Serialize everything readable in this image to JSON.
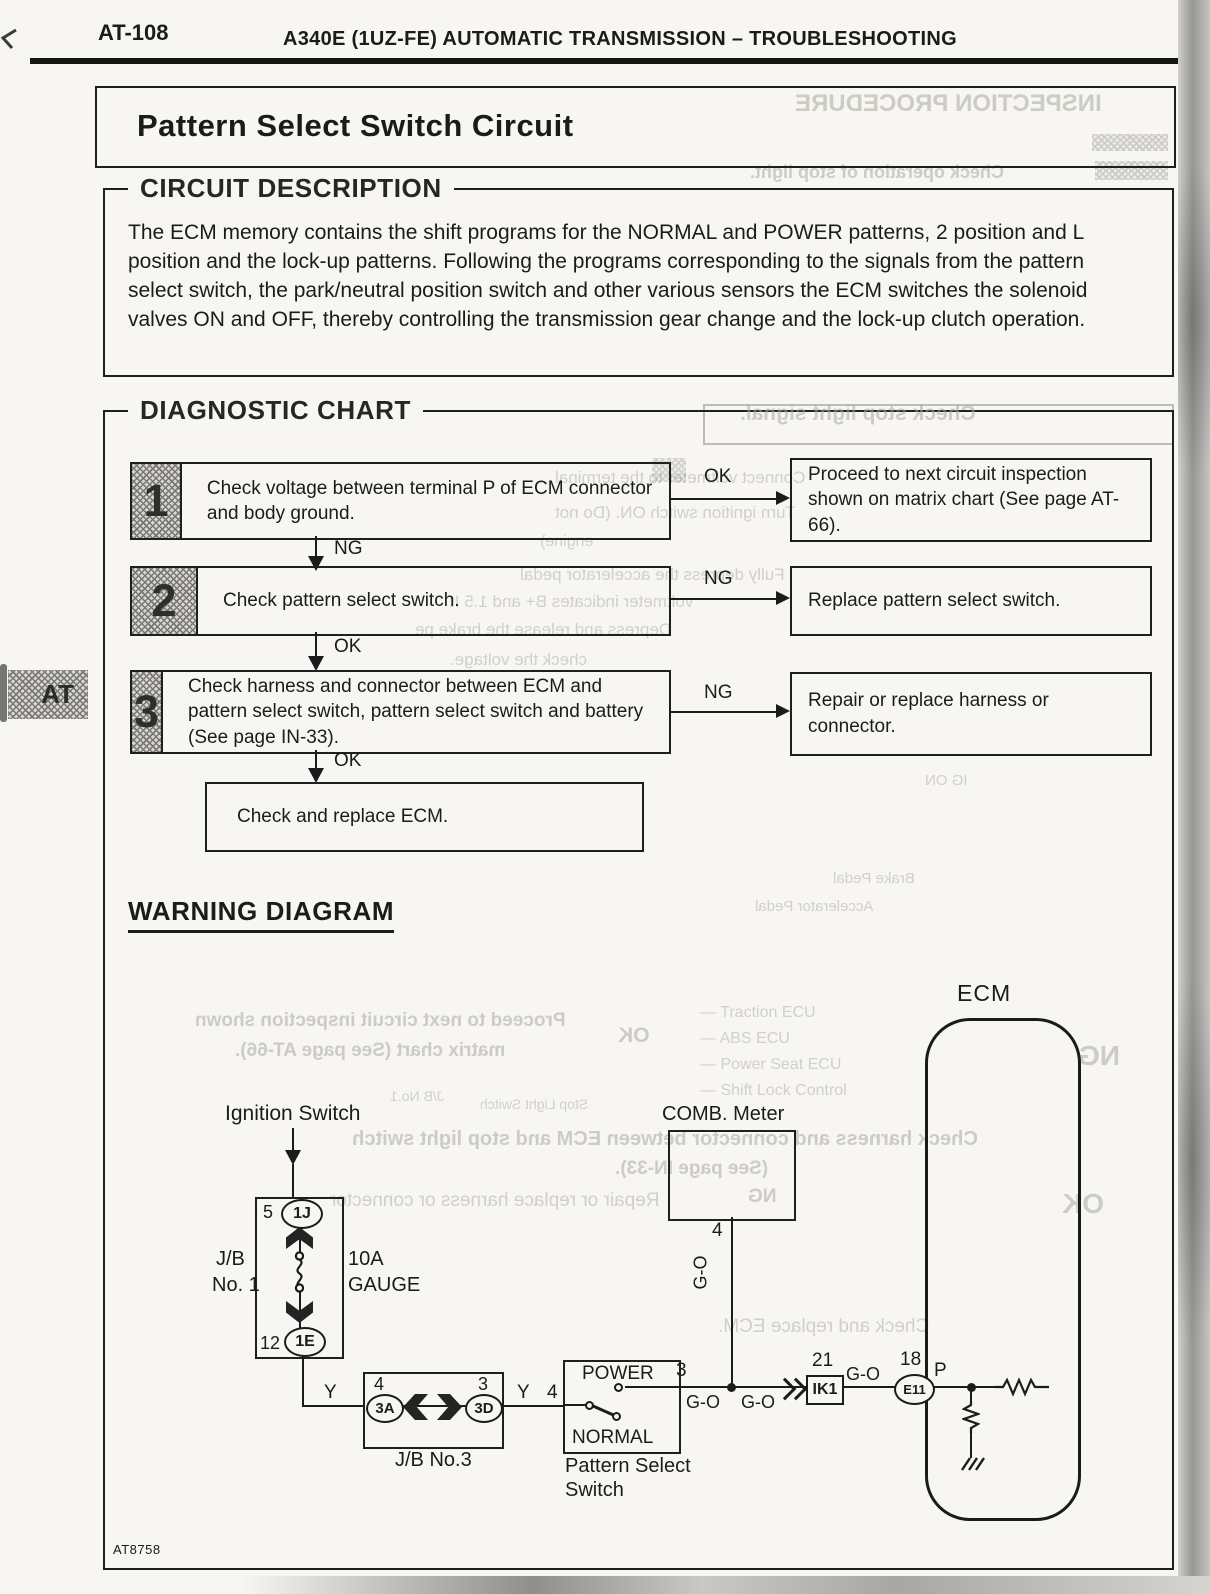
{
  "page": {
    "code": "AT-108",
    "header_title": "A340E (1UZ-FE) AUTOMATIC TRANSMISSION – TROUBLESHOOTING",
    "side_tab": "AT",
    "figure_code": "AT8758"
  },
  "title": "Pattern Select Switch Circuit",
  "circuit_description": {
    "heading": "CIRCUIT DESCRIPTION",
    "body": "The ECM memory contains the shift programs for the NORMAL and POWER patterns, 2 position and L position and the lock-up patterns. Following the programs corresponding to the signals from the pattern select switch, the park/neutral position switch and other various sensors the ECM switches the solenoid valves ON and OFF, thereby controlling the transmission gear change and the lock-up clutch operation."
  },
  "diagnostic_chart": {
    "heading": "DIAGNOSTIC CHART",
    "steps": [
      {
        "num": "1",
        "text": "Check voltage between terminal P of ECM connector and body ground.",
        "side_label": "OK",
        "side_result": "Proceed to next circuit inspection shown on matrix chart (See page AT-66).",
        "down_label": "NG"
      },
      {
        "num": "2",
        "text": "Check pattern select switch.",
        "side_label": "NG",
        "side_result": "Replace pattern select switch.",
        "down_label": "OK"
      },
      {
        "num": "3",
        "text": "Check harness and connector between ECM and pattern select switch, pattern select switch and battery (See page IN-33).",
        "side_label": "NG",
        "side_result": "Repair or replace harness or connector.",
        "down_label": "OK"
      }
    ],
    "final_step": "Check and replace ECM."
  },
  "wiring_diagram": {
    "heading": "WARNING DIAGRAM",
    "ignition_switch": "Ignition Switch",
    "jb1_name_line1": "J/B",
    "jb1_name_line2": "No. 1",
    "fuse_rating": "10A",
    "fuse_name": "GAUGE",
    "jb1_pin_top": "5",
    "jb1_conn_top": "1J",
    "jb1_pin_bottom": "12",
    "jb1_conn_bottom": "1E",
    "comb_meter": "COMB. Meter",
    "comb_pin": "4",
    "wire_go_vert": "G-O",
    "wire_y_1": "Y",
    "jb3_pin_left": "4",
    "jb3_conn_left": "3A",
    "jb3_pin_right": "3",
    "jb3_conn_right": "3D",
    "jb3_name": "J/B No.3",
    "wire_y_2": "Y",
    "wire_4": "4",
    "switch_pos_power": "POWER",
    "switch_pos_normal": "NORMAL",
    "switch_name_line1": "Pattern Select",
    "switch_name_line2": "Switch",
    "out_pin": "3",
    "wire_go_1": "G-O",
    "wire_go_2": "G-O",
    "ik1_pin": "21",
    "ik1_conn": "IK1",
    "wire_go_3": "G-O",
    "e11_pin": "18",
    "e11_conn": "E11",
    "ecm_pin": "P",
    "ecm": "ECM"
  },
  "ghosts": [
    {
      "text": "INSPECTION PROCEDURE"
    },
    {
      "text": "Check operation of stop light."
    },
    {
      "text": "Check stop light signal."
    },
    {
      "text": "Connect voltmeter to the terminal"
    },
    {
      "text": "Turn ignition switch ON. (Do not"
    },
    {
      "text": "engine)"
    },
    {
      "text": "Fully depress the accelerator pedal"
    },
    {
      "text": "voltmeter indicates B+ and 1.5 It"
    },
    {
      "text": "Depress and release the brake pe"
    },
    {
      "text": "check the voltage."
    },
    {
      "text": "IG ON"
    },
    {
      "text": "Brake Pedal"
    },
    {
      "text": "Accelerator Pedal"
    },
    {
      "text": "Proceed to next circuit inspection shown"
    },
    {
      "text": "matrix chart (See page AT-66)."
    },
    {
      "text": "OK"
    },
    {
      "text": "— Traction ECU"
    },
    {
      "text": "— ABS ECU"
    },
    {
      "text": "— Power Seat ECU"
    },
    {
      "text": "— Shift Lock Control"
    },
    {
      "text": "J/B No.1"
    },
    {
      "text": "Stop Light Switch"
    },
    {
      "text": "Check harness and connector between ECM and stop light switch"
    },
    {
      "text": "(See page IN-33)."
    },
    {
      "text": "Repair or replace harness or connector"
    },
    {
      "text": "NG"
    },
    {
      "text": "Check and replace ECM."
    },
    {
      "text": "NG"
    },
    {
      "text": "OK"
    }
  ]
}
